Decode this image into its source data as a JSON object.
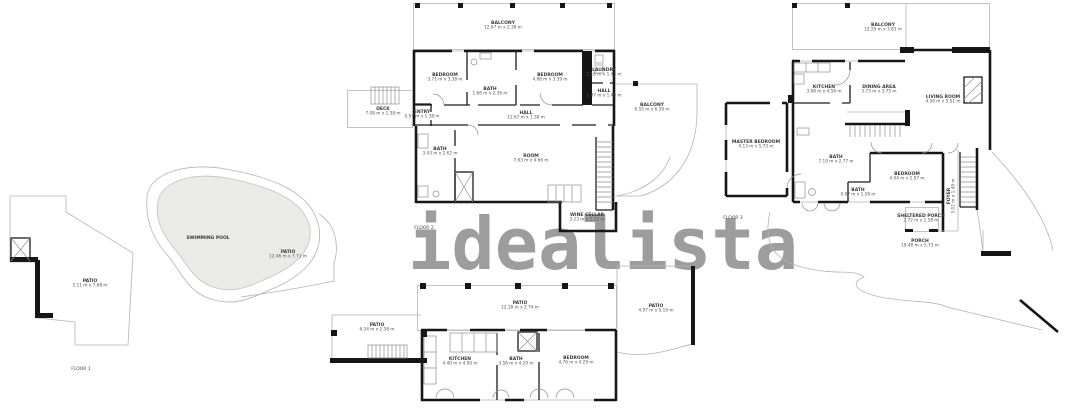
{
  "watermark": "idealista",
  "colors": {
    "wall": "#161616",
    "thin_line": "#b4b4b4",
    "pool_fill": "#eaeae8",
    "watermark_gray": "#9d9d9d"
  },
  "floors": {
    "floor1": {
      "label": "FLOOR 1",
      "patio_left": {
        "name": "PATIO",
        "dims": "5.11 m x 7.68 m"
      },
      "pool": {
        "name": "SWIMMING POOL"
      },
      "patio_right": {
        "name": "PATIO",
        "dims": "12.46 m x 7.71 m"
      }
    },
    "floor2": {
      "label": "FLOOR 2",
      "balcony_top": {
        "name": "BALCONY",
        "dims": "12.67 m x 2.38 m"
      },
      "bedroom_left": {
        "name": "BEDROOM",
        "dims": "3.71 m x 3.38 m"
      },
      "bath_top": {
        "name": "BATH",
        "dims": "1.66 m x 2.36 m"
      },
      "bedroom_right": {
        "name": "BEDROOM",
        "dims": "4.88 m x 3.39 m"
      },
      "laundry": {
        "name": "LAUNDRY",
        "dims": "2.16 m x 1.43 m"
      },
      "hall_small": {
        "name": "HALL",
        "dims": "1.47 m x 1.48 m"
      },
      "hall": {
        "name": "HALL",
        "dims": "11.67 m x 1.38 m"
      },
      "deck": {
        "name": "DECK",
        "dims": "7.08 m x 1.38 m"
      },
      "entry": {
        "name": "ENTRY",
        "dims": "0.97 m x 1.38 m"
      },
      "bath_lower": {
        "name": "BATH",
        "dims": "3.43 m x 2.62 m"
      },
      "room": {
        "name": "ROOM",
        "dims": "7.63 m x 4.66 m"
      },
      "wine_cellar": {
        "name": "WINE CELLAR",
        "dims": "3.23 m x 1.72 m"
      },
      "balcony_right": {
        "name": "BALCONY",
        "dims": "6.55 m x 6.39 m"
      }
    },
    "floor0": {
      "patio_top": {
        "name": "PATIO",
        "dims": "12.18 m x 2.74 m"
      },
      "patio_left": {
        "name": "PATIO",
        "dims": "6.34 m x 2.58 m"
      },
      "kitchen": {
        "name": "KITCHEN",
        "dims": "4.40 m x 4.00 m"
      },
      "bath": {
        "name": "BATH",
        "dims": "3.56 m x 4.20 m"
      },
      "bedroom": {
        "name": "BEDROOM",
        "dims": "4.76 m x 4.29 m"
      },
      "patio_right": {
        "name": "PATIO",
        "dims": "4.97 m x 5.19 m"
      }
    },
    "floor3": {
      "label": "FLOOR 3",
      "balcony": {
        "name": "BALCONY",
        "dims": "12.29 m x 3.83 m"
      },
      "kitchen": {
        "name": "KITCHEN",
        "dims": "3.68 m x 4.56 m"
      },
      "dining": {
        "name": "DINING AREA",
        "dims": "3.73 m x 3.75 m"
      },
      "living": {
        "name": "LIVING ROOM",
        "dims": "4.56 m x 5.51 m"
      },
      "master_bedroom": {
        "name": "MASTER BEDROOM",
        "dims": "4.13 m x 5.73 m"
      },
      "bath_main": {
        "name": "BATH",
        "dims": "7.19 m x 2.77 m"
      },
      "bath_small": {
        "name": "BATH",
        "dims": "0.97 m x 1.58 m"
      },
      "bedroom": {
        "name": "BEDROOM",
        "dims": "4.04 m x 2.97 m"
      },
      "sheltered_porch": {
        "name": "SHELTERED PORCH",
        "dims": "2.72 m x 1.58 m"
      },
      "foyer": {
        "name": "FOYER",
        "dims": "3.01 m x 1.49 m"
      },
      "porch": {
        "name": "PORCH",
        "dims": "19.48 m x 5.73 m"
      }
    }
  }
}
